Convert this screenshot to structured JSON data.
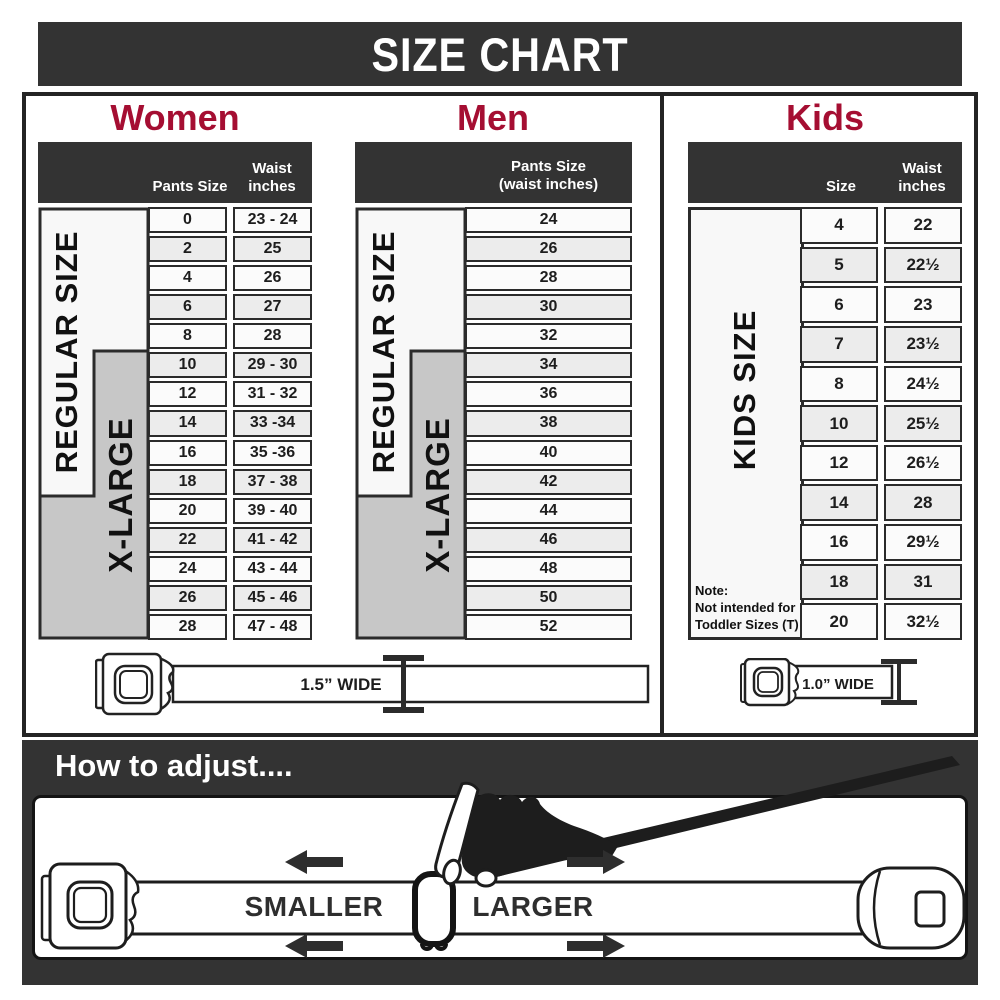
{
  "title": "SIZE CHART",
  "colors": {
    "accent_red": "#a50e32",
    "dark_bar": "#333333",
    "border_dark": "#2b2b2b",
    "gray_box": "#c7c7c7",
    "white_box": "#f8f8f8",
    "row_alt": "#ececec"
  },
  "sections": {
    "women": {
      "heading": "Women",
      "col1_header": "Pants Size",
      "col2_header": "Waist\ninches",
      "regular_label": "REGULAR SIZE",
      "xlarge_label": "X-LARGE",
      "rows": [
        [
          "0",
          "23 - 24"
        ],
        [
          "2",
          "25"
        ],
        [
          "4",
          "26"
        ],
        [
          "6",
          "27"
        ],
        [
          "8",
          "28"
        ],
        [
          "10",
          "29 - 30"
        ],
        [
          "12",
          "31 - 32"
        ],
        [
          "14",
          "33 -34"
        ],
        [
          "16",
          "35 -36"
        ],
        [
          "18",
          "37 - 38"
        ],
        [
          "20",
          "39 - 40"
        ],
        [
          "22",
          "41 - 42"
        ],
        [
          "24",
          "43 - 44"
        ],
        [
          "26",
          "45 - 46"
        ],
        [
          "28",
          "47 - 48"
        ]
      ]
    },
    "men": {
      "heading": "Men",
      "col_header": "Pants Size\n(waist inches)",
      "regular_label": "REGULAR SIZE",
      "xlarge_label": "X-LARGE",
      "rows": [
        "24",
        "26",
        "28",
        "30",
        "32",
        "34",
        "36",
        "38",
        "40",
        "42",
        "44",
        "46",
        "48",
        "50",
        "52"
      ]
    },
    "kids": {
      "heading": "Kids",
      "col1_header": "Size",
      "col2_header": "Waist\ninches",
      "kids_label": "KIDS SIZE",
      "note": "Note:\nNot intended for\nToddler Sizes (T)",
      "rows": [
        [
          "4",
          "22"
        ],
        [
          "5",
          "22½"
        ],
        [
          "6",
          "23"
        ],
        [
          "7",
          "23½"
        ],
        [
          "8",
          "24½"
        ],
        [
          "10",
          "25½"
        ],
        [
          "12",
          "26½"
        ],
        [
          "14",
          "28"
        ],
        [
          "16",
          "29½"
        ],
        [
          "18",
          "31"
        ],
        [
          "20",
          "32½"
        ]
      ]
    }
  },
  "belts": {
    "adult_label": "1.5” WIDE",
    "kids_label": "1.0” WIDE"
  },
  "adjust": {
    "heading": "How to adjust....",
    "smaller_label": "SMALLER",
    "larger_label": "LARGER"
  }
}
